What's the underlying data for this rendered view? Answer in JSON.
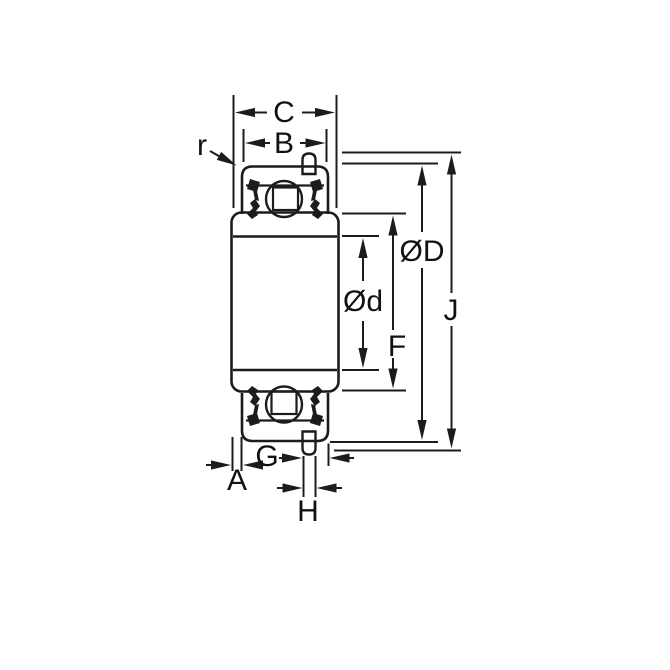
{
  "figure": {
    "title": "Ball bearing cross-section dimensional drawing",
    "background_color": "#ffffff",
    "line_color": "#1c1c1c",
    "text_color": "#111111"
  },
  "labels": {
    "inner_ring_width": "C",
    "outer_ring_width": "B",
    "corner_radius": "r",
    "outer_diameter": "ØD",
    "bore_diameter": "Ød",
    "flinger_diameter": "F",
    "overall_diameter": "J",
    "pin_to_face": "G",
    "face_offset": "A",
    "pin_width": "H"
  }
}
